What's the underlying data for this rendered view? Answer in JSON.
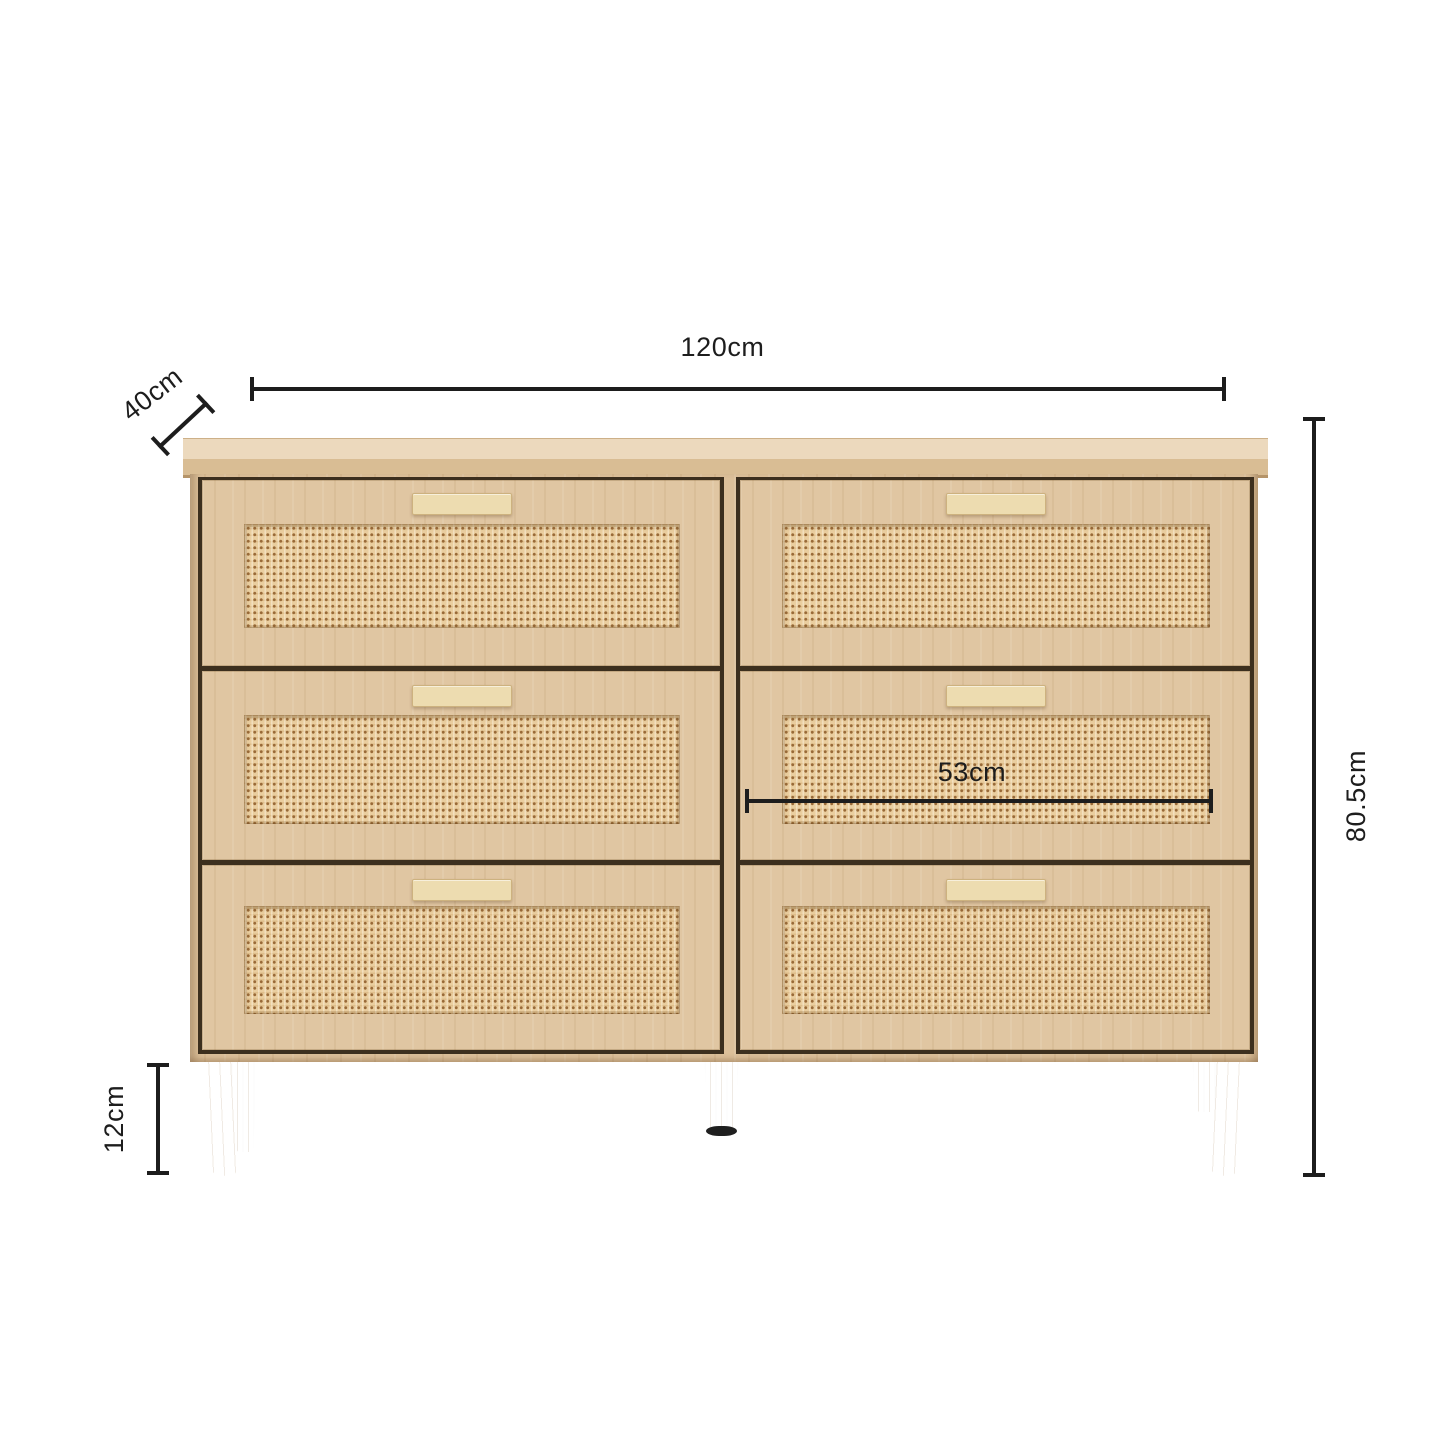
{
  "title": "Chest of drawers dimension diagram",
  "dimensions": {
    "width": {
      "label": "120cm"
    },
    "depth": {
      "label": "40cm"
    },
    "height": {
      "label": "80.5cm"
    },
    "drawer_width": {
      "label": "53cm"
    },
    "leg_height": {
      "label": "12cm"
    }
  },
  "colors": {
    "line": "#1d1d1d",
    "wood": "#dcc09a",
    "wood-light": "#ecd9bd",
    "wood-mid": "#d9bd94",
    "rattan": "#eace9f",
    "rattan-dot": "#996a38",
    "handle": "#eddcb0",
    "gap": "#3c2f1e",
    "leg": "#e0c7a0",
    "foot": "#1f1f1f"
  }
}
